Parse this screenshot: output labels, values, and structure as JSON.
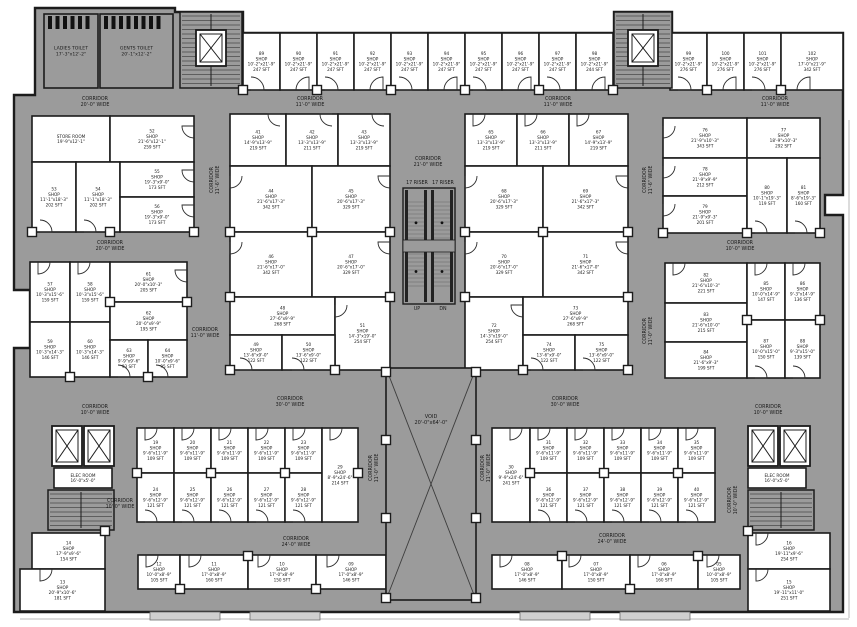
{
  "meta": {
    "type": "commercial-floor-plan"
  },
  "colors": {
    "plan_gray": "#9b9b9b",
    "room_white": "#ffffff",
    "wall": "#1c1c1c",
    "text": "#1a1a1a",
    "hatch": "#4a4a4a",
    "rail": "#222222"
  },
  "plan": {
    "outline": "35,8 175,8 175,12 243,12 243,33 614,33 614,12 672,12 672,33 843,33 843,195 825,195 825,215 843,215 843,612 14,612 14,348 30,348 30,290 14,290 14,95 35,95",
    "hairlines": [
      [
        849,
        120,
        849,
        618
      ],
      [
        20,
        619,
        849,
        619
      ]
    ],
    "porches": [
      [
        150,
        612,
        70,
        8
      ],
      [
        250,
        612,
        70,
        8
      ],
      [
        520,
        612,
        70,
        8
      ],
      [
        620,
        612,
        70,
        8
      ]
    ]
  },
  "rooms": [
    [
      "LADIES TOILET|17'-3\"x12'-2\"",
      44,
      14,
      54,
      74,
      1
    ],
    [
      "GENTS TOILET|20'-1\"x12'-2\"",
      100,
      14,
      73,
      74,
      1
    ],
    [
      "89|SHOP|10'-2\"x21'-9\"|247 SFT",
      243,
      33,
      37,
      57
    ],
    [
      "90|SHOP|10'-2\"x21'-9\"|247 SFT",
      280,
      33,
      37,
      57
    ],
    [
      "91|SHOP|10'-2\"x21'-9\"|247 SFT",
      317,
      33,
      37,
      57
    ],
    [
      "92|SHOP|10'-2\"x21'-9\"|247 SFT",
      354,
      33,
      37,
      57
    ],
    [
      "93|SHOP|10'-2\"x21'-9\"|247 SFT",
      391,
      33,
      37,
      57
    ],
    [
      "94|SHOP|10'-2\"x21'-9\"|247 SFT",
      428,
      33,
      37,
      57
    ],
    [
      "95|SHOP|10'-2\"x21'-9\"|247 SFT",
      465,
      33,
      37,
      57
    ],
    [
      "96|SHOP|10'-2\"x21'-9\"|247 SFT",
      502,
      33,
      37,
      57
    ],
    [
      "97|SHOP|10'-2\"x21'-9\"|247 SFT",
      539,
      33,
      37,
      57
    ],
    [
      "98|SHOP|10'-2\"x21'-9\"|244 SFT",
      576,
      33,
      37,
      57
    ],
    [
      "99|SHOP|10'-2\"x21'-9\"|276 SFT",
      670,
      33,
      37,
      57
    ],
    [
      "100|SHOP|10'-2\"x21'-9\"|276 SFT",
      707,
      33,
      37,
      57
    ],
    [
      "101|SHOP|10'-2\"x21'-9\"|276 SFT",
      744,
      33,
      37,
      57
    ],
    [
      "102|SHOP|17'-0\"x21'-9\"|342 SFT",
      781,
      33,
      62,
      57
    ],
    [
      "STORE ROOM|19'-9\"x12'-1\"",
      32,
      116,
      78,
      46
    ],
    [
      "52|SHOP|21'-6\"x12'-1\"|259 SFT",
      110,
      116,
      84,
      46
    ],
    [
      "53|SHOP|11'-1\"x18'-3\"|202 SFT",
      32,
      162,
      44,
      70
    ],
    [
      "54|SHOP|11'-1\"x18'-3\"|202 SFT",
      76,
      162,
      44,
      70
    ],
    [
      "55|SHOP|19'-3\"x9'-0\"|173 SFT",
      120,
      162,
      74,
      35
    ],
    [
      "56|SHOP|19'-3\"x9'-0\"|173 SFT",
      120,
      197,
      74,
      35
    ],
    [
      "57|SHOP|10'-3\"x15'-6\"|159 SFT",
      30,
      262,
      40,
      60
    ],
    [
      "58|SHOP|10'-3\"x15'-6\"|159 SFT",
      70,
      262,
      40,
      60
    ],
    [
      "59|SHOP|10'-3\"x14'-3\"|146 SFT",
      30,
      322,
      40,
      55
    ],
    [
      "60|SHOP|10'-3\"x14'-3\"|146 SFT",
      70,
      322,
      40,
      55
    ],
    [
      "61|SHOP|20'-0\"x10'-3\"|205 SFT",
      110,
      262,
      77,
      40
    ],
    [
      "62|SHOP|20'-0\"x9'-9\"|195 SFT",
      110,
      302,
      77,
      38
    ],
    [
      "63|SHOP|9'-9\"x9'-6\"|93 SFT",
      110,
      340,
      38,
      37
    ],
    [
      "64|SHOP|10'-0\"x9'-6\"|95 SFT",
      148,
      340,
      39,
      37
    ],
    [
      "41|SHOP|14'-9\"x13'-9\"|219 SFT",
      230,
      114,
      56,
      52
    ],
    [
      "42|SHOP|13'-3\"x13'-9\"|211 SFT",
      286,
      114,
      52,
      52
    ],
    [
      "43|SHOP|13'-3\"x13'-9\"|219 SFT",
      338,
      114,
      52,
      52
    ],
    [
      "44|SHOP|21'-6\"x17'-3\"|342 SFT",
      230,
      166,
      82,
      66
    ],
    [
      "45|SHOP|20'-6\"x17'-3\"|329 SFT",
      312,
      166,
      78,
      66
    ],
    [
      "46|SHOP|21'-6\"x17'-0\"|342 SFT",
      230,
      232,
      82,
      65
    ],
    [
      "47|SHOP|20'-6\"x17'-0\"|329 SFT",
      312,
      232,
      78,
      65
    ],
    [
      "48|SHOP|27'-6\"x9'-9\"|268 SFT",
      230,
      297,
      105,
      38
    ],
    [
      "51|SHOP|14'-3\"x19'-0\"|254 SFT",
      335,
      297,
      55,
      73
    ],
    [
      "49|SHOP|13'-6\"x9'-0\"|122 SFT",
      230,
      335,
      52,
      35
    ],
    [
      "50|SHOP|13'-6\"x9'-0\"|122 SFT",
      282,
      335,
      53,
      35
    ],
    [
      "65|SHOP|13'-3\"x13'-9\"|219 SFT",
      465,
      114,
      52,
      52
    ],
    [
      "66|SHOP|13'-3\"x13'-9\"|211 SFT",
      517,
      114,
      52,
      52
    ],
    [
      "67|SHOP|14'-9\"x13'-9\"|219 SFT",
      569,
      114,
      59,
      52
    ],
    [
      "68|SHOP|20'-6\"x17'-3\"|329 SFT",
      465,
      166,
      78,
      66
    ],
    [
      "69|SHOP|21'-6\"x17'-3\"|342 SFT",
      543,
      166,
      85,
      66
    ],
    [
      "70|SHOP|20'-6\"x17'-0\"|329 SFT",
      465,
      232,
      78,
      65
    ],
    [
      "71|SHOP|21'-6\"x17'-0\"|342 SFT",
      543,
      232,
      85,
      65
    ],
    [
      "72|SHOP|14'-3\"x19'-0\"|254 SFT",
      465,
      297,
      58,
      73
    ],
    [
      "73|SHOP|27'-6\"x9'-9\"|268 SFT",
      523,
      297,
      105,
      38
    ],
    [
      "74|SHOP|13'-6\"x9'-0\"|122 SFT",
      523,
      335,
      52,
      35
    ],
    [
      "75|SHOP|13'-6\"x9'-0\"|122 SFT",
      575,
      335,
      53,
      35
    ],
    [
      "76|SHOP|21'-9\"x10'-3\"|343 SFT",
      663,
      118,
      84,
      40
    ],
    [
      "77|SHOP|18'-9\"x10'-3\"|292 SFT",
      747,
      118,
      73,
      40
    ],
    [
      "78|SHOP|21'-9\"x9'-9\"|212 SFT",
      663,
      158,
      84,
      38
    ],
    [
      "79|SHOP|21'-9\"x9'-3\"|201 SFT",
      663,
      196,
      84,
      37
    ],
    [
      "80|SHOP|10'-1\"x19'-3\"|119 SFT",
      747,
      158,
      40,
      75
    ],
    [
      "81|SHOP|8'-6\"x19'-3\"|160 SFT",
      787,
      158,
      33,
      75
    ],
    [
      "82|SHOP|21'-6\"x10'-3\"|221 SFT",
      665,
      263,
      82,
      40
    ],
    [
      "83|SHOP|21'-6\"x10'-0\"|215 SFT",
      665,
      303,
      82,
      39
    ],
    [
      "84|SHOP|21'-6\"x9'-3\"|199 SFT",
      665,
      342,
      82,
      36
    ],
    [
      "85|SHOP|10'-0\"x14'-9\"|147 SFT",
      747,
      263,
      38,
      57
    ],
    [
      "86|SHOP|9'-3\"x14'-9\"|136 SFT",
      785,
      263,
      35,
      57
    ],
    [
      "87|SHOP|10'-0\"x15'-0\"|150 SFT",
      747,
      320,
      38,
      58
    ],
    [
      "88|SHOP|9'-3\"x15'-0\"|139 SFT",
      785,
      320,
      35,
      58
    ],
    [
      "19|SHOP|9'-6\"x11'-9\"|109 SFT",
      137,
      428,
      37,
      45
    ],
    [
      "20|SHOP|9'-6\"x11'-9\"|109 SFT",
      174,
      428,
      37,
      45
    ],
    [
      "21|SHOP|9'-6\"x11'-9\"|109 SFT",
      211,
      428,
      37,
      45
    ],
    [
      "22|SHOP|9'-6\"x11'-9\"|109 SFT",
      248,
      428,
      37,
      45
    ],
    [
      "23|SHOP|9'-6\"x11'-9\"|109 SFT",
      285,
      428,
      37,
      45
    ],
    [
      "24|SHOP|9'-6\"x12'-9\"|121 SFT",
      137,
      473,
      37,
      49
    ],
    [
      "25|SHOP|9'-6\"x12'-9\"|121 SFT",
      174,
      473,
      37,
      49
    ],
    [
      "26|SHOP|9'-6\"x12'-9\"|121 SFT",
      211,
      473,
      37,
      49
    ],
    [
      "27|SHOP|9'-6\"x12'-9\"|121 SFT",
      248,
      473,
      37,
      49
    ],
    [
      "28|SHOP|9'-6\"x12'-9\"|121 SFT",
      285,
      473,
      37,
      49
    ],
    [
      "29|SHOP|8'-9\"x24'-6\"|214 SFT",
      322,
      428,
      36,
      94
    ],
    [
      "30|SHOP|9'-9\"x24'-6\"|241 SFT",
      492,
      428,
      38,
      94
    ],
    [
      "31|SHOP|9'-6\"x11'-9\"|109 SFT",
      530,
      428,
      37,
      45
    ],
    [
      "32|SHOP|9'-6\"x11'-9\"|109 SFT",
      567,
      428,
      37,
      45
    ],
    [
      "33|SHOP|9'-6\"x11'-9\"|109 SFT",
      604,
      428,
      37,
      45
    ],
    [
      "34|SHOP|9'-6\"x11'-9\"|109 SFT",
      641,
      428,
      37,
      45
    ],
    [
      "35|SHOP|9'-6\"x11'-9\"|109 SFT",
      678,
      428,
      37,
      45
    ],
    [
      "36|SHOP|9'-6\"x12'-9\"|121 SFT",
      530,
      473,
      37,
      49
    ],
    [
      "37|SHOP|9'-6\"x12'-9\"|121 SFT",
      567,
      473,
      37,
      49
    ],
    [
      "38|SHOP|9'-6\"x12'-9\"|121 SFT",
      604,
      473,
      37,
      49
    ],
    [
      "39|SHOP|9'-6\"x12'-9\"|121 SFT",
      641,
      473,
      37,
      49
    ],
    [
      "40|SHOP|9'-6\"x12'-9\"|121 SFT",
      678,
      473,
      37,
      49
    ],
    [
      "12|SHOP|10'-0\"x8'-9\"|105 SFT",
      138,
      555,
      42,
      34
    ],
    [
      "11|SHOP|17'-0\"x8'-9\"|160 SFT",
      180,
      555,
      68,
      34
    ],
    [
      "10|SHOP|17'-0\"x8'-9\"|150 SFT",
      248,
      555,
      68,
      34
    ],
    [
      "09|SHOP|17'-0\"x8'-9\"|146 SFT",
      316,
      555,
      70,
      34
    ],
    [
      "08|SHOP|17'-0\"x8'-9\"|146 SFT",
      492,
      555,
      70,
      34
    ],
    [
      "07|SHOP|17'-0\"x8'-9\"|150 SFT",
      562,
      555,
      68,
      34
    ],
    [
      "06|SHOP|17'-0\"x8'-9\"|160 SFT",
      630,
      555,
      68,
      34
    ],
    [
      "05|SHOP|10'-0\"x8'-9\"|105 SFT",
      698,
      555,
      42,
      34
    ],
    [
      "14|SHOP|17'-9\"x9'-6\"|154 SFT",
      32,
      533,
      73,
      36
    ],
    [
      "13|SHOP|20'-9\"x10'-6\"|181 SFT",
      20,
      569,
      85,
      42
    ],
    [
      "16|SHOP|19'-11\"x9'-6\"|254 SFT",
      748,
      533,
      82,
      36
    ],
    [
      "15|SHOP|19'-11\"x11'-0\"|251 SFT",
      748,
      569,
      82,
      42
    ],
    [
      "ELEC ROOM|16'-0\"x5'-0\"",
      54,
      468,
      58,
      20
    ],
    [
      "ELEC ROOM|16'-0\"x5'-0\"",
      748,
      468,
      58,
      20
    ]
  ],
  "labels": [
    [
      95,
      100,
      "CORRIDOR|20'-0\" WIDE",
      0
    ],
    [
      310,
      100,
      "CORRIDOR|11'-0\" WIDE",
      0
    ],
    [
      558,
      100,
      "CORRIDOR|11'-0\" WIDE",
      0
    ],
    [
      775,
      100,
      "CORRIDOR|11'-0\" WIDE",
      0
    ],
    [
      428,
      160,
      "CORRIDOR|21'-0\" WIDE",
      0
    ],
    [
      213,
      180,
      "CORRIDOR|11'-6\" WIDE",
      1
    ],
    [
      646,
      180,
      "CORRIDOR|11'-6\" WIDE",
      1
    ],
    [
      110,
      244,
      "CORRIDOR|20'-0\" WIDE",
      0
    ],
    [
      740,
      244,
      "CORRIDOR|10'-0\" WIDE",
      0
    ],
    [
      205,
      331,
      "CORRIDOR|11'-0\" WIDE",
      0
    ],
    [
      646,
      331,
      "CORRIDOR|11'-0\" WIDE",
      1
    ],
    [
      290,
      400,
      "CORRIDOR|30'-0\" WIDE",
      0
    ],
    [
      565,
      400,
      "CORRIDOR|30'-0\" WIDE",
      0
    ],
    [
      95,
      408,
      "CORRIDOR|10'-0\" WIDE",
      0
    ],
    [
      768,
      408,
      "CORRIDOR|10'-0\" WIDE",
      0
    ],
    [
      372,
      468,
      "CORRIDOR|11'-0\" WIDE",
      1
    ],
    [
      484,
      468,
      "CORRIDOR|11'-0\" WIDE",
      1
    ],
    [
      120,
      502,
      "CORRIDOR|10'-0\" WIDE",
      0
    ],
    [
      296,
      540,
      "CORRIDOR|24'-0\" WIDE",
      0
    ],
    [
      612,
      537,
      "CORRIDOR|24'-0\" WIDE",
      0
    ],
    [
      731,
      500,
      "CORRIDOR|10'-0\" WIDE",
      1
    ],
    [
      417,
      184,
      "17 RISER",
      0
    ],
    [
      443,
      184,
      "17 RISER",
      0
    ],
    [
      417,
      310,
      "UP",
      0
    ],
    [
      443,
      310,
      "DN",
      0
    ]
  ],
  "void": {
    "x": 386,
    "y": 368,
    "w": 90,
    "h": 232,
    "label": "VOID|20'-0\"x64'-0\"",
    "label_y": 418
  },
  "escalator": {
    "x": 403,
    "y": 188,
    "w": 52,
    "h": 116
  },
  "stairs": [
    [
      180,
      12,
      62,
      76
    ],
    [
      614,
      12,
      58,
      76
    ],
    [
      48,
      490,
      66,
      40
    ],
    [
      748,
      490,
      66,
      40
    ]
  ],
  "lifts": [
    [
      196,
      30,
      30,
      36
    ],
    [
      628,
      30,
      30,
      36
    ],
    [
      52,
      426,
      30,
      40
    ],
    [
      84,
      426,
      30,
      40
    ],
    [
      748,
      426,
      30,
      40
    ],
    [
      780,
      426,
      30,
      40
    ]
  ],
  "stalls": [
    [
      48,
      16,
      6
    ],
    [
      104,
      16,
      8
    ]
  ],
  "columns": [
    [
      243,
      90
    ],
    [
      317,
      90
    ],
    [
      391,
      90
    ],
    [
      465,
      90
    ],
    [
      539,
      90
    ],
    [
      613,
      90
    ],
    [
      707,
      90
    ],
    [
      781,
      90
    ],
    [
      32,
      232
    ],
    [
      110,
      232
    ],
    [
      194,
      232
    ],
    [
      230,
      232
    ],
    [
      312,
      232
    ],
    [
      390,
      232
    ],
    [
      465,
      232
    ],
    [
      543,
      232
    ],
    [
      628,
      232
    ],
    [
      663,
      233
    ],
    [
      747,
      233
    ],
    [
      820,
      233
    ],
    [
      230,
      297
    ],
    [
      390,
      297
    ],
    [
      465,
      297
    ],
    [
      628,
      297
    ],
    [
      110,
      302
    ],
    [
      187,
      302
    ],
    [
      747,
      320
    ],
    [
      820,
      320
    ],
    [
      230,
      370
    ],
    [
      335,
      370
    ],
    [
      523,
      370
    ],
    [
      628,
      370
    ],
    [
      70,
      377
    ],
    [
      148,
      377
    ],
    [
      386,
      372
    ],
    [
      476,
      372
    ],
    [
      386,
      440
    ],
    [
      476,
      440
    ],
    [
      386,
      518
    ],
    [
      476,
      518
    ],
    [
      386,
      598
    ],
    [
      476,
      598
    ],
    [
      137,
      473
    ],
    [
      211,
      473
    ],
    [
      285,
      473
    ],
    [
      358,
      473
    ],
    [
      530,
      473
    ],
    [
      604,
      473
    ],
    [
      678,
      473
    ],
    [
      180,
      589
    ],
    [
      248,
      556
    ],
    [
      316,
      589
    ],
    [
      562,
      556
    ],
    [
      630,
      589
    ],
    [
      698,
      556
    ],
    [
      105,
      531
    ],
    [
      748,
      531
    ]
  ],
  "doors": [
    [
      251,
      90,
      13,
      0
    ],
    [
      309,
      90,
      13,
      90
    ],
    [
      325,
      90,
      13,
      0
    ],
    [
      383,
      90,
      13,
      90
    ],
    [
      399,
      90,
      13,
      0
    ],
    [
      457,
      90,
      13,
      90
    ],
    [
      473,
      90,
      13,
      0
    ],
    [
      531,
      90,
      13,
      90
    ],
    [
      547,
      90,
      13,
      0
    ],
    [
      605,
      90,
      13,
      90
    ],
    [
      678,
      90,
      13,
      0
    ],
    [
      736,
      90,
      13,
      90
    ],
    [
      752,
      90,
      13,
      0
    ],
    [
      810,
      90,
      13,
      90
    ],
    [
      280,
      114,
      12,
      180
    ],
    [
      332,
      114,
      12,
      180
    ],
    [
      384,
      114,
      12,
      180
    ],
    [
      230,
      176,
      12,
      270
    ],
    [
      390,
      176,
      12,
      180
    ],
    [
      230,
      242,
      12,
      270
    ],
    [
      390,
      242,
      12,
      180
    ],
    [
      335,
      305,
      12,
      270
    ],
    [
      240,
      370,
      12,
      0
    ],
    [
      292,
      370,
      12,
      0
    ],
    [
      473,
      114,
      12,
      270
    ],
    [
      525,
      114,
      12,
      270
    ],
    [
      577,
      114,
      12,
      270
    ],
    [
      465,
      176,
      12,
      270
    ],
    [
      628,
      176,
      12,
      180
    ],
    [
      465,
      242,
      12,
      270
    ],
    [
      628,
      242,
      12,
      180
    ],
    [
      523,
      305,
      12,
      180
    ],
    [
      531,
      370,
      12,
      0
    ],
    [
      583,
      370,
      12,
      0
    ],
    [
      194,
      126,
      12,
      180
    ],
    [
      194,
      170,
      12,
      180
    ],
    [
      194,
      205,
      12,
      180
    ],
    [
      40,
      232,
      12,
      0
    ],
    [
      84,
      232,
      12,
      0
    ],
    [
      38,
      262,
      12,
      270
    ],
    [
      78,
      262,
      12,
      270
    ],
    [
      187,
      270,
      12,
      180
    ],
    [
      118,
      377,
      12,
      0
    ],
    [
      156,
      377,
      12,
      0
    ],
    [
      663,
      126,
      12,
      270
    ],
    [
      663,
      166,
      12,
      270
    ],
    [
      663,
      204,
      12,
      270
    ],
    [
      755,
      233,
      12,
      0
    ],
    [
      795,
      233,
      12,
      0
    ],
    [
      673,
      263,
      12,
      270
    ],
    [
      755,
      263,
      12,
      270
    ],
    [
      793,
      263,
      12,
      270
    ],
    [
      755,
      378,
      12,
      0
    ],
    [
      793,
      378,
      12,
      0
    ],
    [
      145,
      428,
      12,
      270
    ],
    [
      182,
      428,
      12,
      270
    ],
    [
      219,
      428,
      12,
      270
    ],
    [
      256,
      428,
      12,
      270
    ],
    [
      293,
      428,
      12,
      270
    ],
    [
      145,
      522,
      12,
      0
    ],
    [
      182,
      522,
      12,
      0
    ],
    [
      219,
      522,
      12,
      0
    ],
    [
      256,
      522,
      12,
      0
    ],
    [
      293,
      522,
      12,
      0
    ],
    [
      330,
      428,
      12,
      270
    ],
    [
      538,
      428,
      12,
      270
    ],
    [
      575,
      428,
      12,
      270
    ],
    [
      612,
      428,
      12,
      270
    ],
    [
      649,
      428,
      12,
      270
    ],
    [
      686,
      428,
      12,
      270
    ],
    [
      538,
      522,
      12,
      0
    ],
    [
      575,
      522,
      12,
      0
    ],
    [
      612,
      522,
      12,
      0
    ],
    [
      649,
      522,
      12,
      0
    ],
    [
      686,
      522,
      12,
      0
    ],
    [
      510,
      428,
      12,
      270
    ],
    [
      146,
      555,
      12,
      270
    ],
    [
      189,
      555,
      12,
      270
    ],
    [
      258,
      555,
      12,
      270
    ],
    [
      327,
      555,
      12,
      270
    ],
    [
      500,
      555,
      12,
      270
    ],
    [
      569,
      555,
      12,
      270
    ],
    [
      638,
      555,
      12,
      270
    ],
    [
      707,
      555,
      12,
      270
    ],
    [
      40,
      569,
      12,
      270
    ],
    [
      756,
      533,
      12,
      270
    ],
    [
      756,
      569,
      12,
      270
    ]
  ]
}
